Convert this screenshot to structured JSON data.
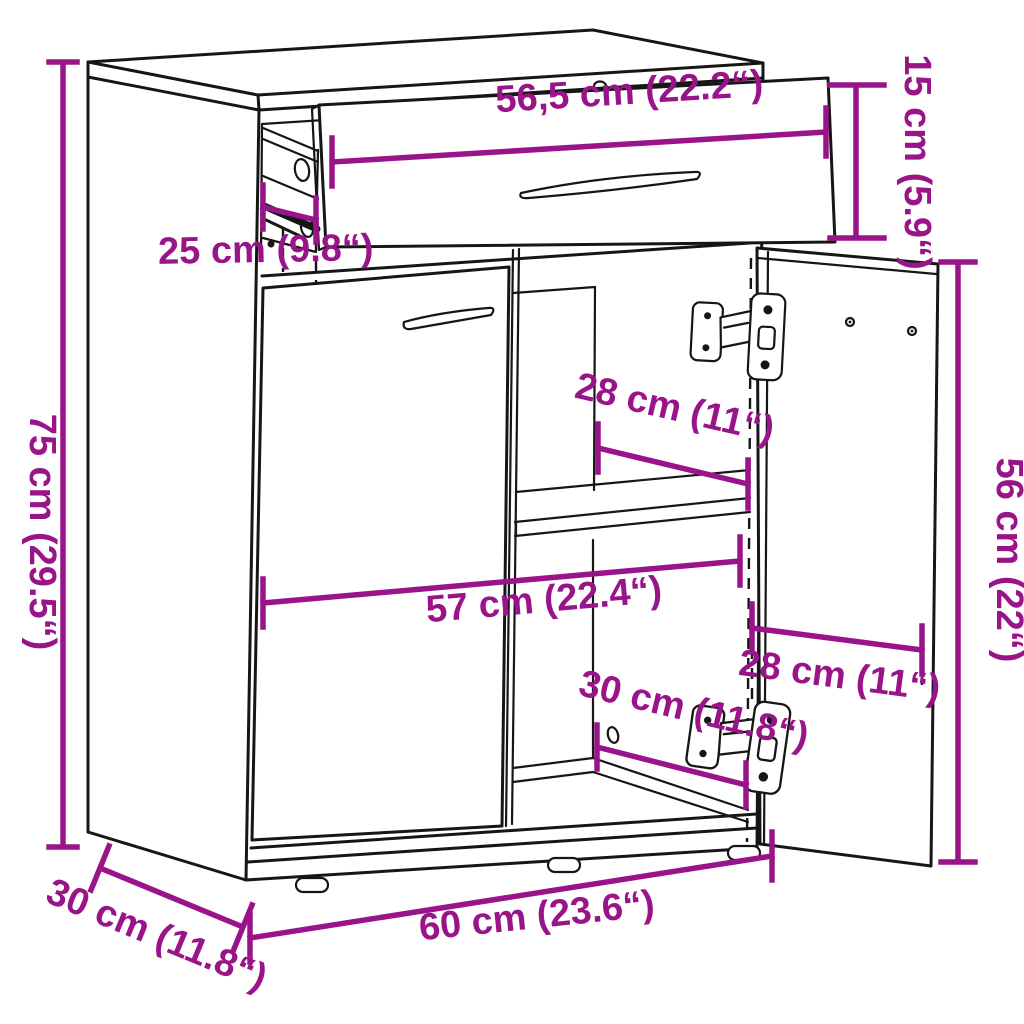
{
  "diagram": {
    "type": "furniture-dimension-diagram",
    "subject": "sideboard cabinet with drawer, two doors (right door open), inner shelf",
    "accent_color": "#9a1489",
    "line_color": "#161616",
    "background_color": "#ffffff",
    "dimensions": {
      "drawer_width": "56,5 cm (22.2“)",
      "drawer_front_height": "15 cm (5.9“)",
      "drawer_rail_depth": "25 cm (9.8“)",
      "overall_height": "75 cm (29.5“)",
      "shelf_depth": "28 cm (11“)",
      "interior_width": "57 cm (22.4“)",
      "interior_bottom_depth": "30 cm (11.8“)",
      "door_width": "28 cm (11“)",
      "door_height": "56 cm (22“)",
      "overall_width": "60 cm (23.6“)",
      "overall_depth": "30 cm (11.8“)"
    }
  }
}
